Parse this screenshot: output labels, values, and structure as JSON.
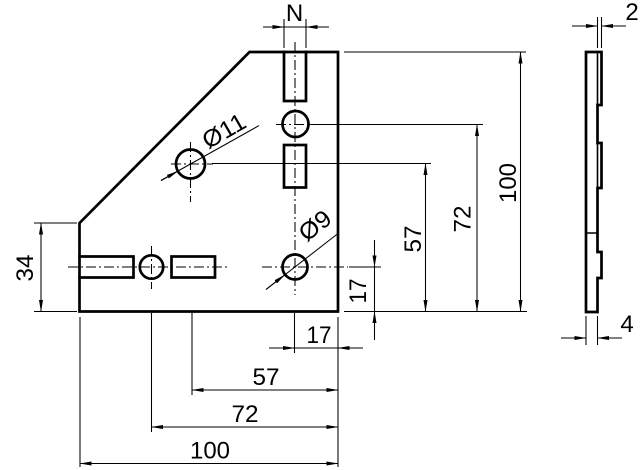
{
  "front": {
    "dim_n": "N",
    "dim_left_height": "34",
    "bottom": {
      "d17": "17",
      "d57": "57",
      "d72": "72",
      "d100": "100"
    },
    "right": {
      "d17": "17",
      "d57": "57",
      "d72": "72",
      "d100": "100"
    },
    "hole_large_label": "Ø11",
    "hole_small_label": "Ø9"
  },
  "side": {
    "dim_thickness_top": "2",
    "dim_thickness_bottom": "4"
  },
  "colors": {
    "line": "#000000",
    "background": "#ffffff"
  }
}
